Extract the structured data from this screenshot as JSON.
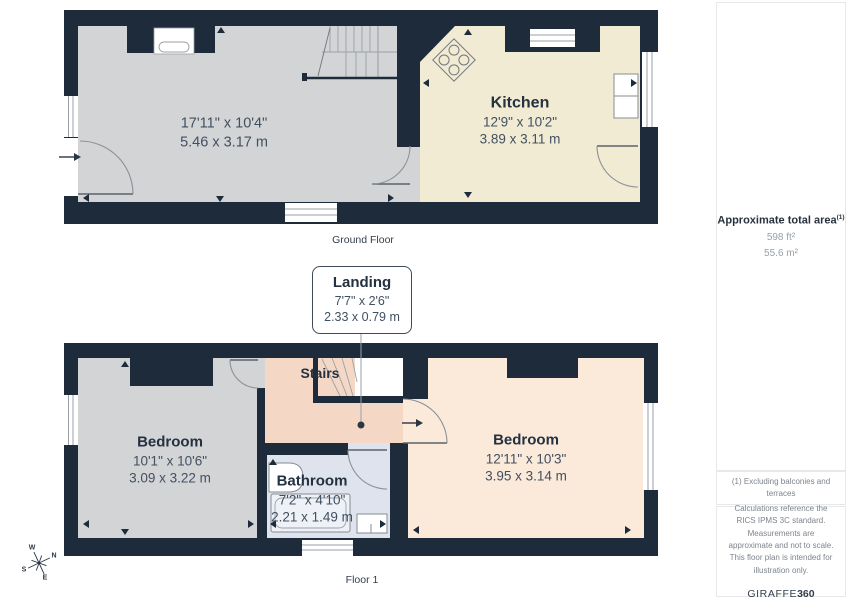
{
  "colors": {
    "wall": "#1d2b3a",
    "room_gray": "#d3d4d6",
    "room_cream": "#f2ebd3",
    "room_peach": "#f4d8c5",
    "room_light_peach": "#fbe9da",
    "room_blue": "#dfe3ee",
    "text_dark": "#243140",
    "text_dim": "#415061",
    "sidebar_muted": "#7d848c"
  },
  "ground_floor": {
    "caption": "Ground Floor",
    "living_room": {
      "dims_ft": "17'11\" x 10'4\"",
      "dims_m": "5.46 x 3.17 m"
    },
    "kitchen": {
      "name": "Kitchen",
      "dims_ft": "12'9\" x 10'2\"",
      "dims_m": "3.89 x 3.11 m"
    }
  },
  "landing_callout": {
    "name": "Landing",
    "dims_ft": "7'7\" x 2'6\"",
    "dims_m": "2.33 x 0.79 m"
  },
  "floor_1": {
    "caption": "Floor 1",
    "stairs_label": "Stairs",
    "bedroom_left": {
      "name": "Bedroom",
      "dims_ft": "10'1\" x 10'6\"",
      "dims_m": "3.09 x 3.22 m"
    },
    "bedroom_right": {
      "name": "Bedroom",
      "dims_ft": "12'11\" x 10'3\"",
      "dims_m": "3.95 x 3.14 m"
    },
    "bathroom": {
      "name": "Bathroom",
      "dims_ft": "7'2\" x 4'10\"",
      "dims_m": "2.21 x 1.49 m"
    }
  },
  "compass": {
    "north": "N",
    "east": "E",
    "south": "S",
    "west": "W"
  },
  "sidebar": {
    "total_area_label": "Approximate total area",
    "total_area_footnote_marker": "(1)",
    "total_area_ft": "598 ft²",
    "total_area_m": "55.6 m²",
    "footnote": "(1) Excluding balconies and terraces",
    "disclaimer": "Calculations reference the RICS IPMS 3C standard. Measurements are approximate and not to scale. This floor plan is intended for illustration only.",
    "brand": {
      "name": "GIRAFFE",
      "suffix": "360"
    }
  }
}
